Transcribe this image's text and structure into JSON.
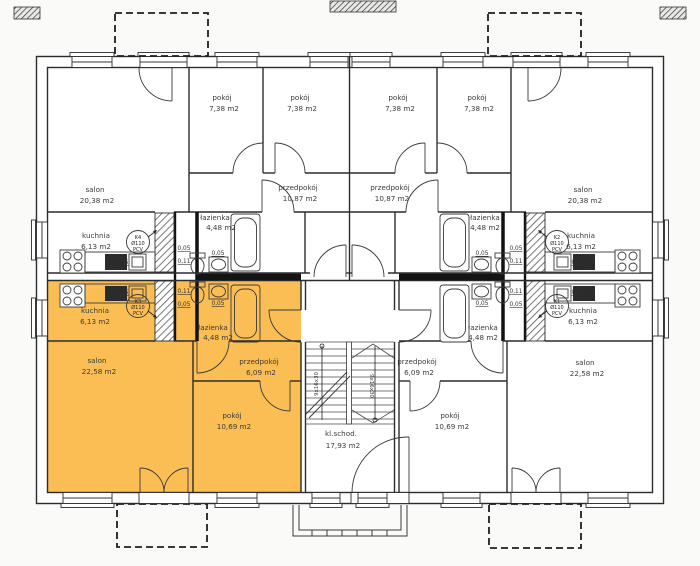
{
  "plan": {
    "title": "storey floor plan",
    "highlight_color": "#FBBE55",
    "rooms": {
      "pokoj_small": {
        "name": "pokój",
        "area": "7,38 m2"
      },
      "pokoj_bottom": {
        "name": "pokój",
        "area": "10,69 m2"
      },
      "salon_top": {
        "name": "salon",
        "area": "20,38 m2"
      },
      "salon_bottom": {
        "name": "salon",
        "area": "22,58 m2"
      },
      "kuchnia": {
        "name": "kuchnia",
        "area": "6,13 m2"
      },
      "przedpokoj_top": {
        "name": "przedpokój",
        "area": "10,87 m2"
      },
      "przedpokoj_bottom": {
        "name": "przedpokój",
        "area": "6,09 m2"
      },
      "lazienka": {
        "name": "łazienka",
        "area": "4,48 m2"
      },
      "staircase": {
        "name": "kl.schod.",
        "area": "17,93 m2"
      }
    },
    "stacks": {
      "k1": "K1",
      "k2": "K2",
      "k3": "K3",
      "k4": "K4",
      "diameter": "Ø110",
      "material": "PCV"
    },
    "dims": {
      "d005": "0,05",
      "d011": "0,11"
    },
    "stair_run": "9x16x30"
  }
}
